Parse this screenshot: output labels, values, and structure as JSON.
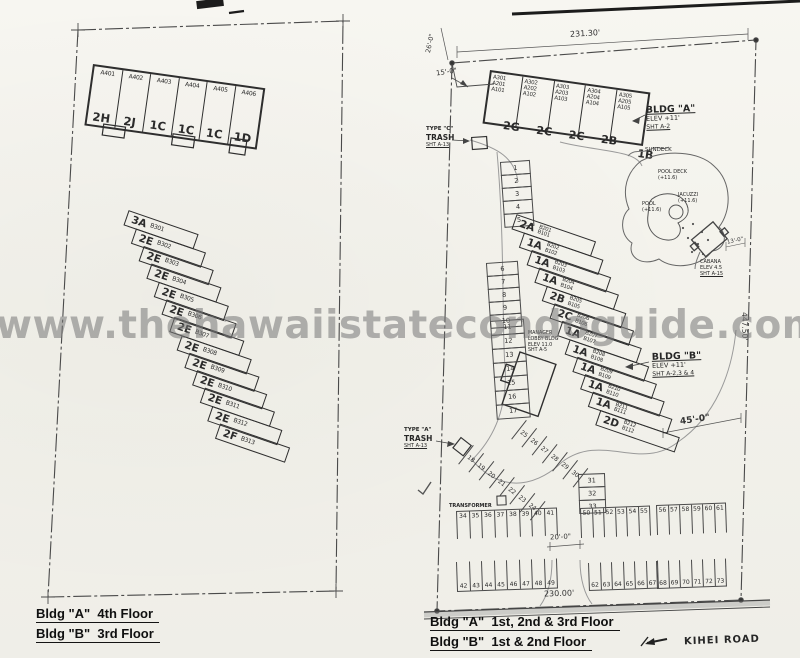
{
  "watermark": "www.thehawaiistatecondoguide.com",
  "left_plan": {
    "top_units": [
      {
        "u": "A401",
        "t": "2H"
      },
      {
        "u": "A402",
        "t": "2J"
      },
      {
        "u": "A403",
        "t": "1C"
      },
      {
        "u": "A404",
        "t": "1C"
      },
      {
        "u": "A405",
        "t": "1C"
      },
      {
        "u": "A406",
        "t": "1D"
      }
    ],
    "rows": [
      {
        "t": "3A",
        "u": "B301"
      },
      {
        "t": "2E",
        "u": "B302"
      },
      {
        "t": "2E",
        "u": "B303"
      },
      {
        "t": "2E",
        "u": "B304"
      },
      {
        "t": "2E",
        "u": "B305"
      },
      {
        "t": "2E",
        "u": "B306"
      },
      {
        "t": "2E",
        "u": "B307"
      },
      {
        "t": "2E",
        "u": "B308"
      },
      {
        "t": "2E",
        "u": "B309"
      },
      {
        "t": "2E",
        "u": "B310"
      },
      {
        "t": "2E",
        "u": "B311"
      },
      {
        "t": "2E",
        "u": "B312"
      },
      {
        "t": "2F",
        "u": "B313"
      }
    ],
    "captions": [
      "Bldg \"A\"  4th Floor",
      "Bldg \"B\"  3rd Floor"
    ]
  },
  "right_plan": {
    "top_stacks": [
      {
        "u3": "A301",
        "u2": "A201",
        "u1": "A101"
      },
      {
        "u3": "A302",
        "u2": "A202",
        "u1": "A102"
      },
      {
        "u3": "A303",
        "u2": "A203",
        "u1": "A103"
      },
      {
        "u3": "A304",
        "u2": "A204",
        "u1": "A104"
      },
      {
        "u3": "A305",
        "u2": "A205",
        "u1": "A105"
      }
    ],
    "top_types": [
      "2G",
      "2C",
      "2C",
      "2B",
      "1B"
    ],
    "rows": [
      {
        "t": "2A",
        "u2": "B201",
        "u1": "B101"
      },
      {
        "t": "1A",
        "u2": "B202",
        "u1": "B102"
      },
      {
        "t": "1A",
        "u2": "B203",
        "u1": "B103"
      },
      {
        "t": "1A",
        "u2": "B204",
        "u1": "B104"
      },
      {
        "t": "2B",
        "u2": "B205",
        "u1": "B105"
      },
      {
        "t": "2C",
        "u2": "B206",
        "u1": "B106"
      },
      {
        "t": "1A",
        "u2": "B207",
        "u1": "B107"
      },
      {
        "t": "1A",
        "u2": "B208",
        "u1": "B108"
      },
      {
        "t": "1A",
        "u2": "B209",
        "u1": "B109"
      },
      {
        "t": "1A",
        "u2": "B210",
        "u1": "B110"
      },
      {
        "t": "1A",
        "u2": "B211",
        "u1": "B111"
      },
      {
        "t": "2D",
        "u2": "B212",
        "u1": "B112"
      }
    ],
    "callout_a": {
      "l1": "BLDG \"A\"",
      "l2": "ELEV +11'",
      "l3": "SHT A-2"
    },
    "callout_b": {
      "l1": "BLDG \"B\"",
      "l2": "ELEV +11'",
      "l3": "SHT A-2,3 & 4"
    },
    "trash_c": {
      "l1": "TYPE \"C\"",
      "l2": "TRASH",
      "l3": "SHT A-13"
    },
    "trash_a": {
      "l1": "TYPE \"A\"",
      "l2": "TRASH",
      "l3": "SHT A-13"
    },
    "manager": {
      "l1": "MANAGER",
      "l2": "LOBBY BLDG",
      "l3": "ELEV 11.0",
      "l4": "SHT A-5"
    },
    "transformer": "TRANSFORMER",
    "pool": {
      "sundeck": "SUNDECK",
      "deck1": "POOL DECK",
      "deck2": "(+11.6)",
      "jac1": "JACUZZI",
      "jac2": "(+11.6)",
      "pool1": "POOL",
      "pool2": "(+11.6)",
      "cab1": "CABANA",
      "cab2": "ELEV 4.5",
      "cab3": "SHT A-15"
    },
    "dims": {
      "top": "231.30'",
      "left": "26'-0\"",
      "left2": "15'-0\"",
      "right": "447.50'",
      "mid45": "45'-0\"",
      "gap20": "20'-0\"",
      "bottom": "230.00'",
      "cabana13": "13'-0\""
    },
    "parking": {
      "col_a": [
        "1",
        "2",
        "3",
        "4",
        "5"
      ],
      "col_b": [
        "6",
        "7",
        "8",
        "9",
        "10"
      ],
      "col_c": [
        "11",
        "12",
        "13",
        "14",
        "15",
        "16",
        "17"
      ],
      "diag_a": [
        "18",
        "19",
        "20",
        "21",
        "22",
        "23",
        "24"
      ],
      "diag_b": [
        "25",
        "26",
        "27",
        "28",
        "29",
        "30"
      ],
      "col_31": [
        "31",
        "32",
        "33"
      ],
      "row_34": [
        "34",
        "35",
        "36",
        "37",
        "38",
        "39",
        "40",
        "41"
      ],
      "row_42": [
        "42",
        "43",
        "44",
        "45",
        "46",
        "47",
        "48",
        "49"
      ],
      "row_50": [
        "50",
        "51",
        "52",
        "53",
        "54",
        "55"
      ],
      "row_56": [
        "56",
        "57",
        "58",
        "59",
        "60",
        "61"
      ],
      "row_62": [
        "62",
        "63",
        "64",
        "65",
        "66",
        "67"
      ],
      "row_68": [
        "68",
        "69",
        "70",
        "71",
        "72",
        "73"
      ]
    },
    "road": "KIHEI ROAD",
    "captions": [
      "Bldg \"A\"  1st, 2nd & 3rd Floor",
      "Bldg \"B\"  1st & 2nd Floor"
    ]
  }
}
